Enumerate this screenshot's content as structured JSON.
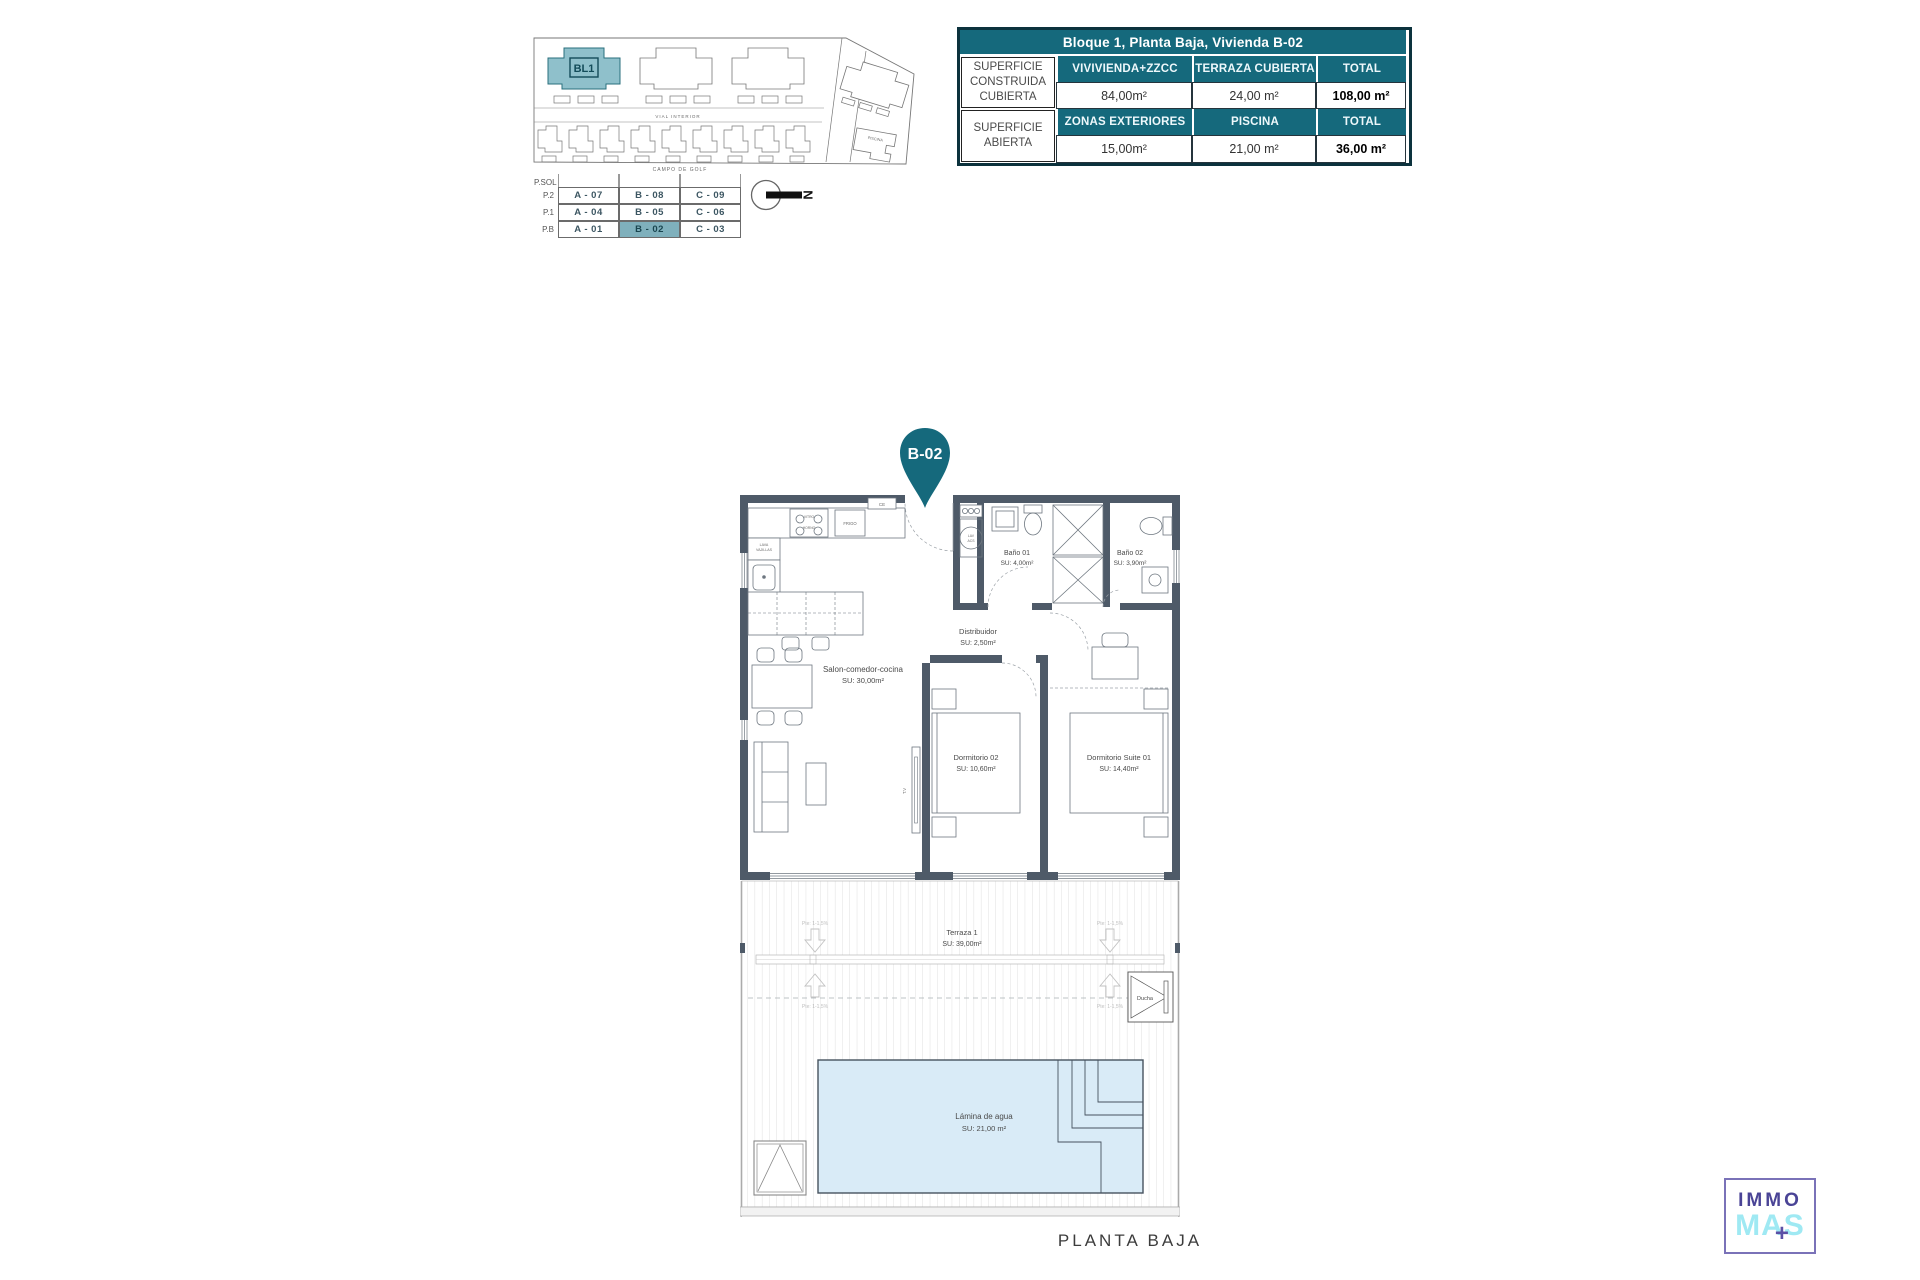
{
  "caption": "PLANTA BAJA",
  "colors": {
    "accent_teal": "#15697c",
    "highlight_teal": "#7fb0bc",
    "wall": "#4e5a68",
    "pool_water": "#d9ebf7",
    "logo_purple": "#4a4496",
    "logo_cyan": "#9fe9f3"
  },
  "site_plan": {
    "block": "BL1",
    "vial": "VIAL INTERIOR",
    "campo": "CAMPO DE GOLF",
    "piscina": "PISCINA"
  },
  "floor_table": {
    "corner": "P.SOL",
    "highlighted": "B - 02",
    "rows": [
      {
        "floor": "P.2",
        "units": [
          "A - 07",
          "B - 08",
          "C - 09"
        ]
      },
      {
        "floor": "P.1",
        "units": [
          "A - 04",
          "B - 05",
          "C - 06"
        ]
      },
      {
        "floor": "P.B",
        "units": [
          "A - 01",
          "B - 02",
          "C - 03"
        ]
      }
    ]
  },
  "north": {
    "letter": "N"
  },
  "surface_table": {
    "title": "Bloque 1, Planta Baja, Vivienda B-02",
    "row1": {
      "label": "SUPERFICIE CONSTRUIDA CUBIERTA",
      "cols": [
        "VIVIVIENDA+ZZCC",
        "TERRAZA CUBIERTA",
        "TOTAL"
      ],
      "values": [
        "84,00m²",
        "24,00 m²",
        "108,00 m²"
      ]
    },
    "row2": {
      "label": "SUPERFICIE ABIERTA",
      "cols": [
        "ZONAS EXTERIORES",
        "PISCINA",
        "TOTAL"
      ],
      "values": [
        "15,00m²",
        "21,00 m²",
        "36,00 m²"
      ]
    }
  },
  "pin": {
    "label": "B-02"
  },
  "rooms": {
    "salon": {
      "name": "Salon-comedor-cocina",
      "area": "SU: 30,00m²"
    },
    "distribuidor": {
      "name": "Distribuidor",
      "area": "SU: 2,50m²"
    },
    "bano1": {
      "name": "Baño 01",
      "area": "SU: 4,00m²"
    },
    "bano2": {
      "name": "Baño 02",
      "area": "SU: 3,90m²"
    },
    "dorm2": {
      "name": "Dormitorio 02",
      "area": "SU: 10,60m²"
    },
    "suite": {
      "name": "Dormitorio Suite 01",
      "area": "SU: 14,40m²"
    },
    "terraza": {
      "name": "Terraza 1",
      "area": "SU: 39,00m²"
    },
    "pool": {
      "name": "Lámina de agua",
      "area": "SU: 21,00 m²"
    },
    "ducha": {
      "name": "Ducha"
    }
  },
  "labels": {
    "vitro": "VITRO",
    "horno": "HORNO",
    "frigo": "FRIGO",
    "lava": "LAVA",
    "vajillas": "VAJILLAS",
    "lav": "LAV",
    "acs": "ACS",
    "tv": "T.V",
    "ce": "CE",
    "slope": "Pte: 1-1,5%"
  },
  "logo": {
    "immo": "IMMO",
    "mas": "MAS",
    "plus": "+"
  }
}
